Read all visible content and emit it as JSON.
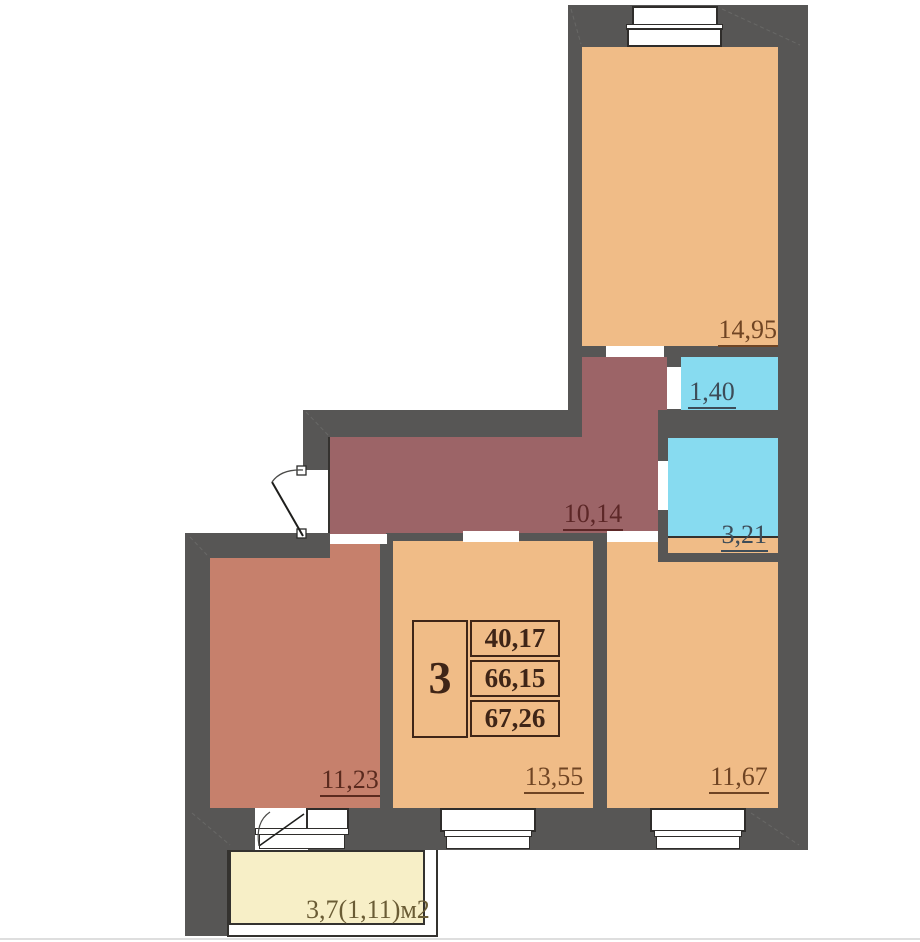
{
  "plan": {
    "kind": "apartment-floor-plan",
    "unit": {
      "number": "3",
      "values": [
        "40,17",
        "66,15",
        "67,26"
      ]
    },
    "areas": {
      "room_top": "14,95",
      "bathroom_small": "1,40",
      "bathroom_large": "3,21",
      "hallway": "10,14",
      "room_left": "11,23",
      "room_middle": "13,55",
      "room_right": "11,67",
      "balcony": "3,7(1,11)м2"
    },
    "colors": {
      "wall": "#575655",
      "room_tan": "#f0bc87",
      "room_salmon": "#c6806c",
      "hallway_maroon": "#9c6467",
      "bathroom_cyan": "#87dbf0",
      "balcony_yellow": "#f7efc7",
      "label_brown": "#6f4423",
      "label_slate": "#3d4c58",
      "table_ink": "#3f2517"
    }
  }
}
